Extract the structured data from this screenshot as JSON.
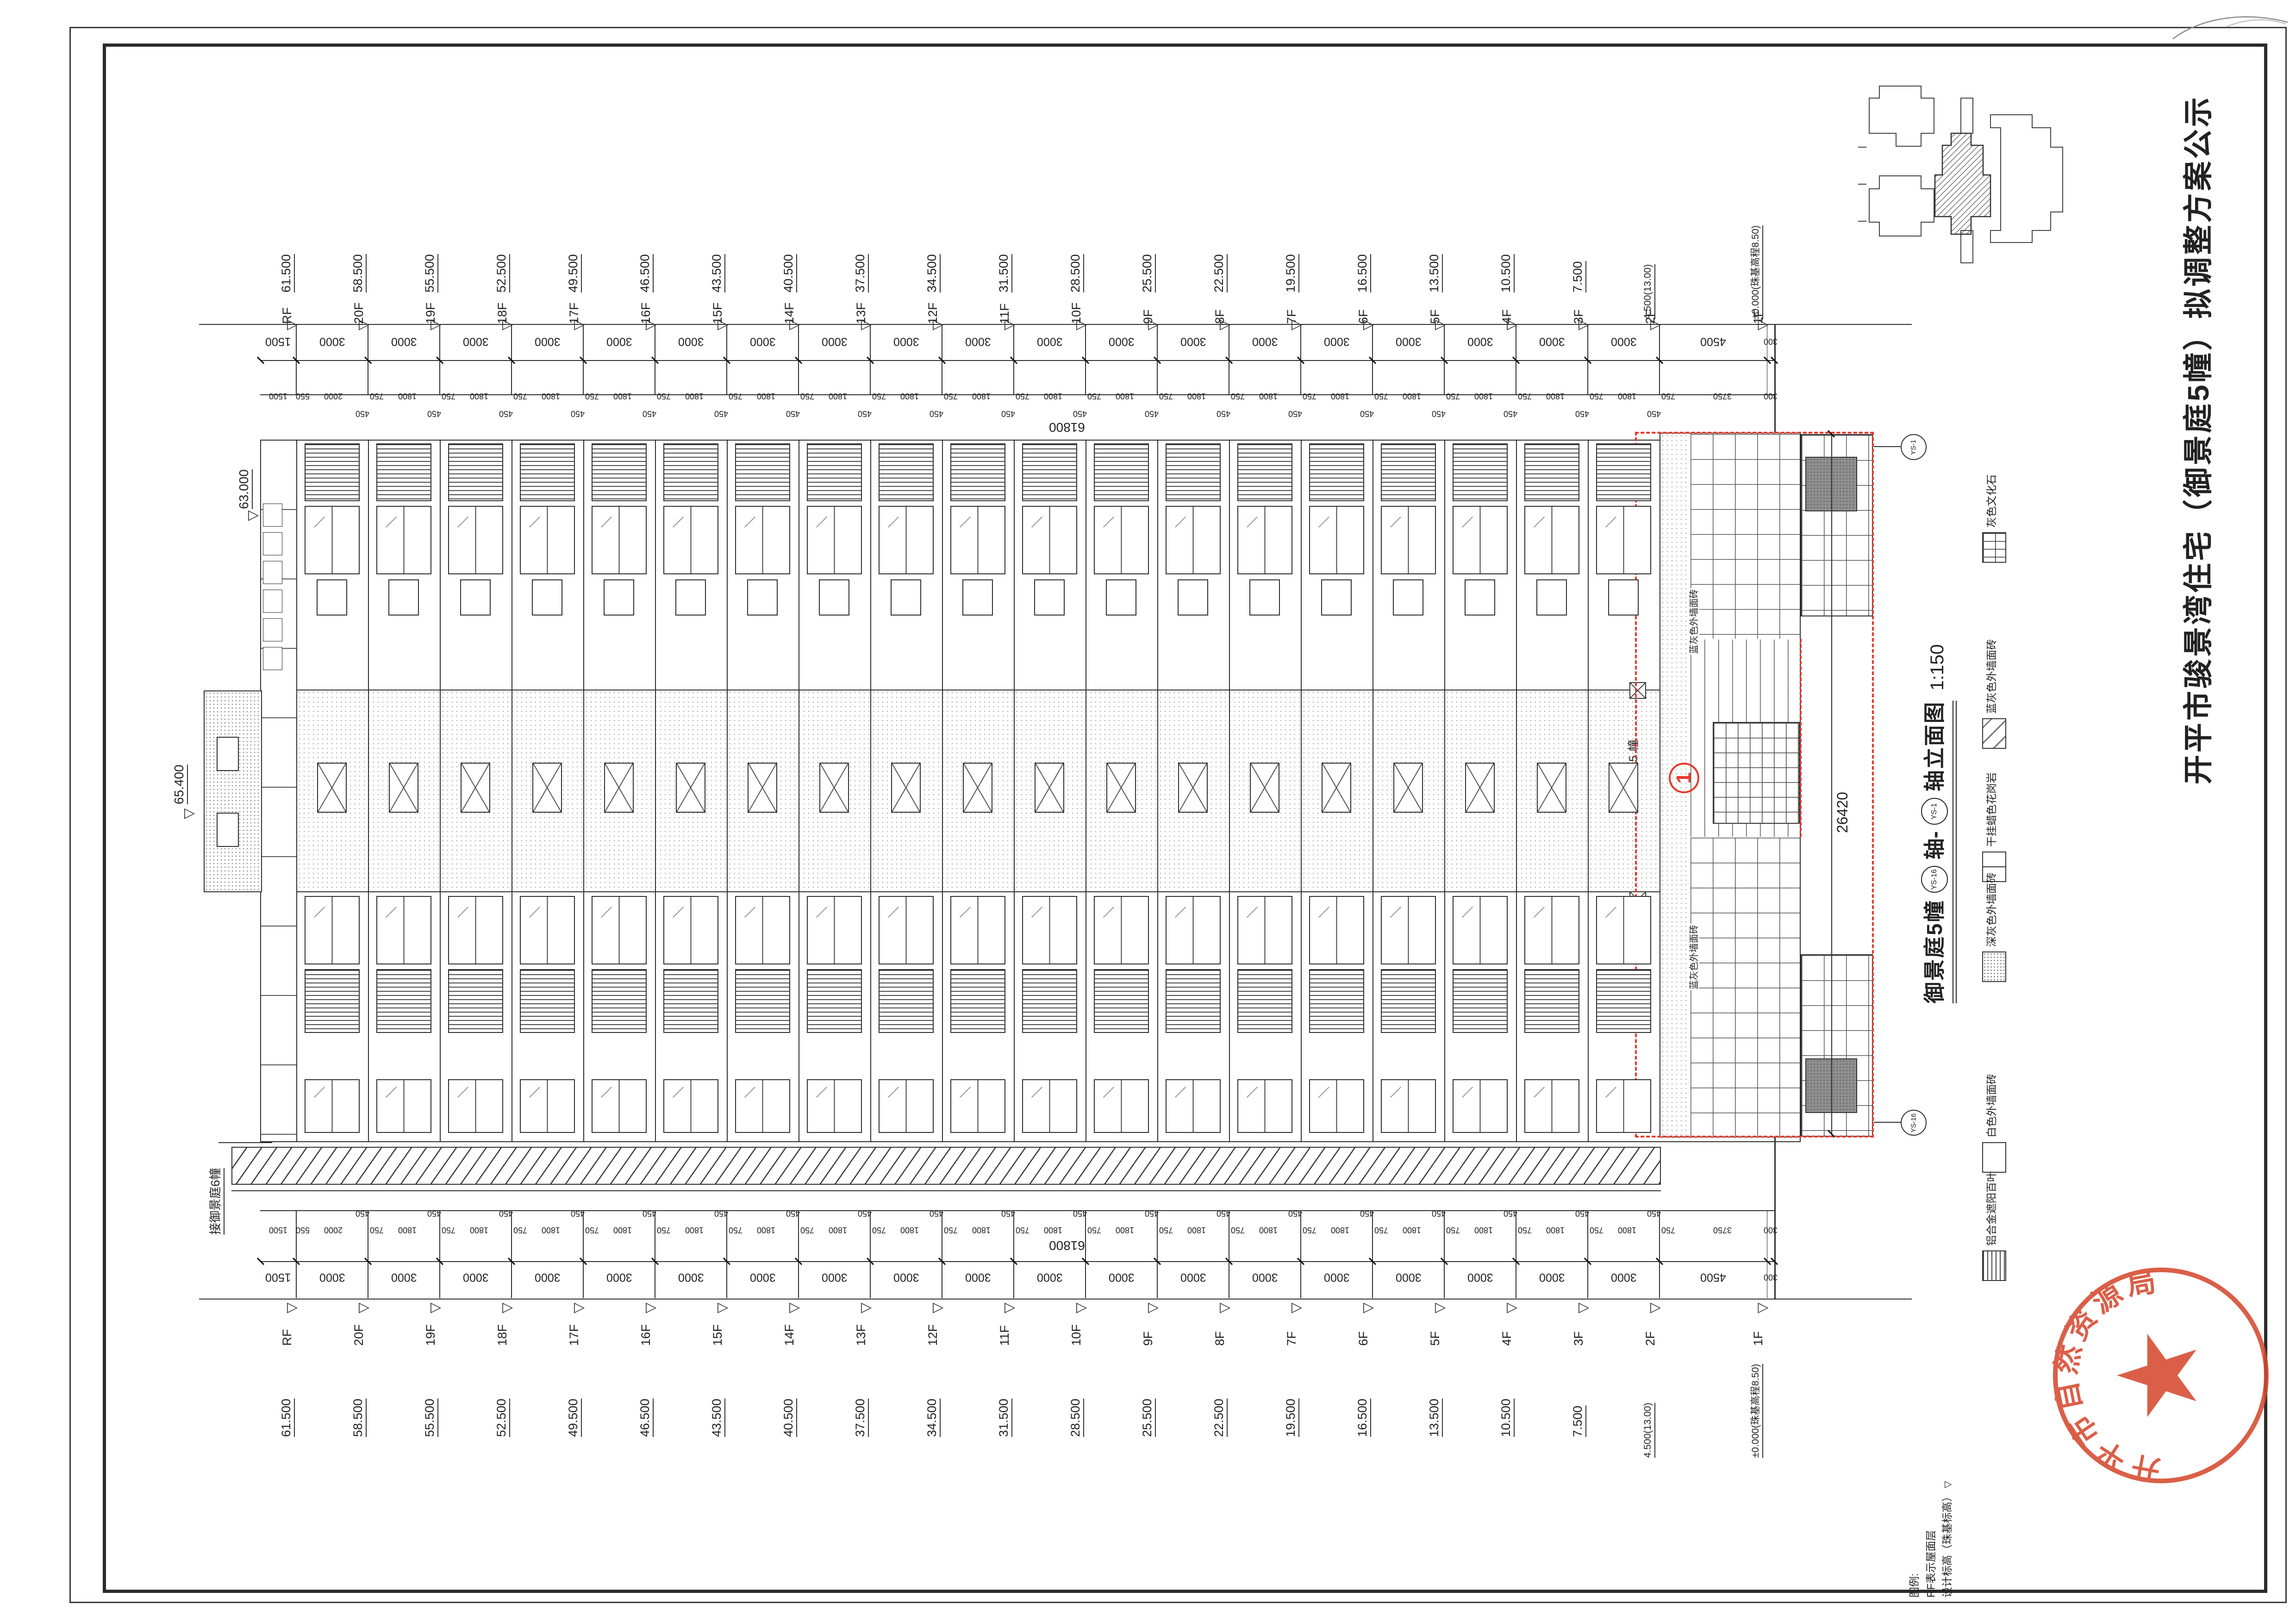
{
  "page_title": "开平市骏景湾住宅（御景庭5幢）拟调整方案公示",
  "drawing": {
    "name_prefix": "御景庭5幢",
    "axis_start": "YS-16",
    "axis_join": "轴-",
    "axis_end": "YS-1",
    "name_suffix": "轴立面图",
    "scale": "1:150"
  },
  "floors": [
    {
      "label": "RF",
      "level": "61.500"
    },
    {
      "label": "20F",
      "level": "58.500"
    },
    {
      "label": "19F",
      "level": "55.500"
    },
    {
      "label": "18F",
      "level": "52.500"
    },
    {
      "label": "17F",
      "level": "49.500"
    },
    {
      "label": "16F",
      "level": "46.500"
    },
    {
      "label": "15F",
      "level": "43.500"
    },
    {
      "label": "14F",
      "level": "40.500"
    },
    {
      "label": "13F",
      "level": "37.500"
    },
    {
      "label": "12F",
      "level": "34.500"
    },
    {
      "label": "11F",
      "level": "31.500"
    },
    {
      "label": "10F",
      "level": "28.500"
    },
    {
      "label": "9F",
      "level": "25.500"
    },
    {
      "label": "8F",
      "level": "22.500"
    },
    {
      "label": "7F",
      "level": "19.500"
    },
    {
      "label": "6F",
      "level": "16.500"
    },
    {
      "label": "5F",
      "level": "13.500"
    },
    {
      "label": "4F",
      "level": "10.500"
    },
    {
      "label": "3F",
      "level": "7.500"
    },
    {
      "label": "2F",
      "level": "4.500(13.00)"
    },
    {
      "label": "1F",
      "level": "±0.000(珠基高程8.50)"
    }
  ],
  "levels_extra": {
    "parapet": "63.000",
    "machine_room": "65.400"
  },
  "dims": {
    "total": "61800",
    "section_width": "26420",
    "major": {
      "start": [
        "1500"
      ],
      "repeat": [
        "3000"
      ],
      "repeat_count": 19,
      "end": [
        "4500",
        "300"
      ]
    },
    "minor": {
      "start": [
        "1500",
        "550",
        "2000",
        "450"
      ],
      "repeat": [
        "750",
        "1800",
        "450"
      ],
      "repeat_count": 18,
      "end": [
        "750",
        "3750",
        "300"
      ]
    }
  },
  "legend": {
    "items": [
      {
        "name": "灰色文化石",
        "pattern": "brick"
      },
      {
        "name": "蓝灰色外墙面砖",
        "pattern": "tile"
      },
      {
        "name": "干挂蜡色花岗岩",
        "pattern": "granite"
      },
      {
        "name": "深灰色外墙面砖",
        "pattern": "stipple"
      },
      {
        "name": "白色外墙面砖",
        "pattern": "plain"
      },
      {
        "name": "铝合金遮阳百叶",
        "pattern": "louver"
      }
    ]
  },
  "notes": {
    "header": "图例:",
    "rf_note": "RF表示屋面层",
    "level_note": "设计标高（珠基标高）"
  },
  "annotations": {
    "adjacent_building": "接御景庭6幢",
    "entrance_sign": "御景庭5幢",
    "section_marker": "1",
    "material_callout": "蓝灰色外墙面砖",
    "axis_bubble_top": "YS-1",
    "axis_bubble_bottom": "YS-16"
  },
  "icons": {
    "level_tri": "▷",
    "level_mark": "▽"
  },
  "stamp": {
    "text": "开平市自然资源局",
    "color": "#d5492f"
  },
  "colors": {
    "line": "#2e2e2e",
    "accent_red": "#e8392b"
  }
}
